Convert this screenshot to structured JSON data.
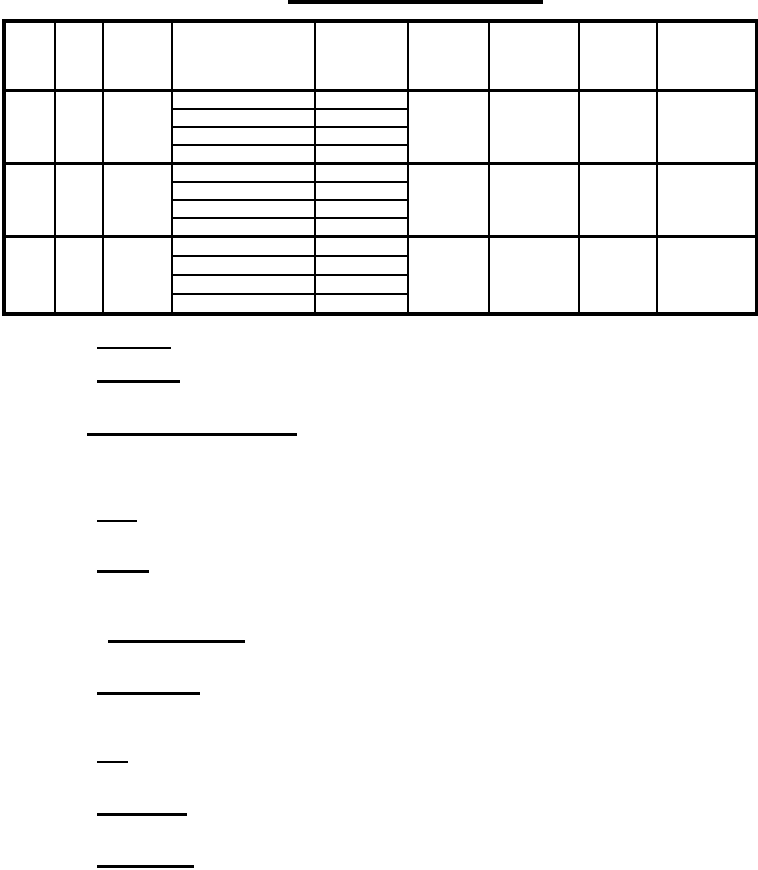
{
  "page": {
    "width": 758,
    "height": 870,
    "background_color": "#ffffff",
    "ink_color": "#000000"
  },
  "document": {
    "kind": "blank-form-page",
    "visible_text": "",
    "title": {
      "text": "",
      "underline": {
        "x": 288,
        "y": 0,
        "width": 255,
        "thickness": 4
      }
    }
  },
  "table": {
    "x": 2,
    "y": 19,
    "width": 753,
    "column_count": 9,
    "column_widths": [
      51,
      48,
      69,
      143,
      93,
      81,
      90,
      78,
      100
    ],
    "header": {
      "height": 71,
      "cells": [
        "",
        "",
        "",
        "",
        "",
        "",
        "",
        "",
        ""
      ]
    },
    "split_column_indexes": [
      3,
      4
    ],
    "groups": [
      {
        "height": 74,
        "sub_rows": 4
      },
      {
        "height": 74,
        "sub_rows": 4
      },
      {
        "height": 78,
        "sub_rows": 4
      }
    ],
    "cell_text": ""
  },
  "underlines": [
    {
      "x": 97,
      "y": 347,
      "width": 74,
      "thickness": 2
    },
    {
      "x": 97,
      "y": 380,
      "width": 83,
      "thickness": 3
    },
    {
      "x": 87,
      "y": 433,
      "width": 210,
      "thickness": 3
    },
    {
      "x": 97,
      "y": 520,
      "width": 40,
      "thickness": 2
    },
    {
      "x": 97,
      "y": 570,
      "width": 52,
      "thickness": 3
    },
    {
      "x": 108,
      "y": 640,
      "width": 137,
      "thickness": 3
    },
    {
      "x": 97,
      "y": 692,
      "width": 103,
      "thickness": 3
    },
    {
      "x": 97,
      "y": 761,
      "width": 31,
      "thickness": 2
    },
    {
      "x": 97,
      "y": 813,
      "width": 90,
      "thickness": 3
    },
    {
      "x": 97,
      "y": 865,
      "width": 97,
      "thickness": 3
    }
  ]
}
